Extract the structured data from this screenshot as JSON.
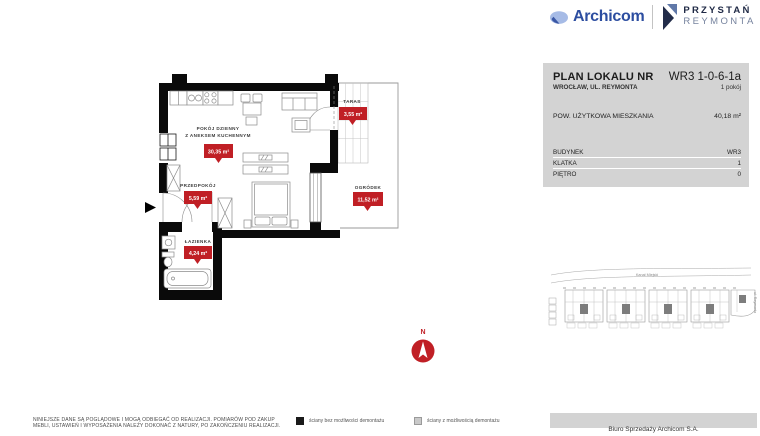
{
  "brand": {
    "archicom": "Archicom",
    "project_line1": "PRZYSTAŃ",
    "project_line2": "REYMONTA"
  },
  "info_panel": {
    "title": "PLAN LOKALU NR",
    "unit_no": "WR3 1-0-6-1a",
    "address": "WROCŁAW, UL. REYMONTA",
    "rooms": "1 pokój",
    "area_label": "POW. UŻYTKOWA MIESZKANIA",
    "area_value": "40,18 m²",
    "details": [
      {
        "label": "BUDYNEK",
        "value": "WR3"
      },
      {
        "label": "KLATKA",
        "value": "1"
      },
      {
        "label": "PIĘTRO",
        "value": "0"
      }
    ]
  },
  "plan": {
    "living": {
      "line1": "POKÓJ DZIENNY",
      "line2": "Z ANEKSEM KUCHENNYM",
      "area": "30,35 m²"
    },
    "hall": {
      "name": "PRZEDPOKÓJ",
      "area": "5,59 m²"
    },
    "bath": {
      "name": "ŁAZIENKA",
      "area": "4,24 m²"
    },
    "terrace": {
      "name": "TARAS",
      "area": "3,55 m²"
    },
    "garden": {
      "name": "OGRÓDEK",
      "area": "11,52 m²"
    }
  },
  "compass": {
    "north": "N"
  },
  "site_plan": {
    "canal": "Kanał Miejski",
    "street": "ul. Reymonta"
  },
  "legend": [
    {
      "label": "ściany bez możliwości demontażu"
    },
    {
      "label": "ściany z możliwością demontażu"
    }
  ],
  "disclaimer": {
    "line1": "NINIEJSZE DANE SĄ POGLĄDOWE I MOGĄ ODBIEGAĆ OD REALIZACJI. POMIARÓW POD ZAKUP",
    "line2": "MEBLI, USTAWIEŃ I WYPOSAŻENIA NALEŻY DOKONAĆ Z NATURY, PO ZAKOŃCZENIU REALIZACJI."
  },
  "footer": {
    "sales_office": "Biuro Sprzedaży Archicom S.A."
  },
  "colors": {
    "badge_red": "#c01f25",
    "panel_gray": "#d3d3d3",
    "brand_blue": "#2c4da0",
    "brand_navy": "#1f2945",
    "wall_black": "#0a0a0a",
    "legend_gray": "#c9c9c9"
  }
}
